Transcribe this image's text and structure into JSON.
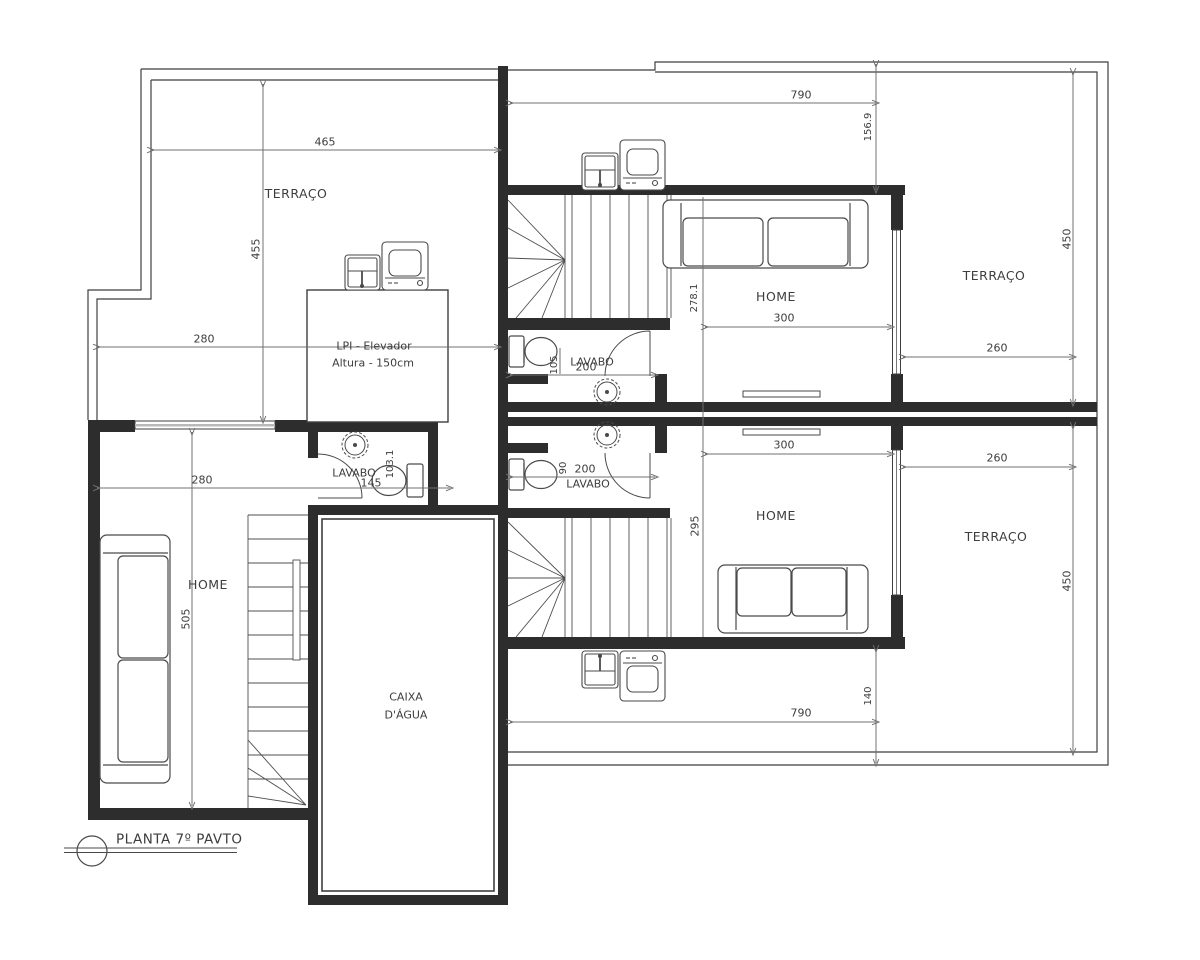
{
  "annotations": {
    "title": "PLANTA 7º PAVTO",
    "elevator_line1": "LPI - Elevador",
    "elevator_line2": "Altura - 150cm",
    "water_tank_line1": "CAIXA",
    "water_tank_line2": "D'ÁGUA"
  },
  "rooms": {
    "terrace_top_left": "TERRAÇO",
    "terrace_top_right": "TERRAÇO",
    "terrace_bottom_right": "TERRAÇO",
    "home_left": "HOME",
    "home_top_right": "HOME",
    "home_bottom_right": "HOME",
    "lavabo_left": "LAVABO",
    "lavabo_top": "LAVABO",
    "lavabo_bottom": "LAVABO"
  },
  "dims": {
    "w465": "465",
    "h455": "455",
    "w280_terrace": "280",
    "w280_home": "280",
    "h505": "505",
    "w145": "145",
    "h103": "103.1",
    "w790_top": "790",
    "h156": "156.9",
    "h450_top": "450",
    "w260_top": "260",
    "w300_top": "300",
    "h278": "278.1",
    "w200_top": "200",
    "h105": "105",
    "w300_bottom": "300",
    "h295": "295",
    "w200_bottom": "200",
    "h90": "90",
    "w260_bottom": "260",
    "h450_bottom": "450",
    "w790_bottom": "790",
    "h140": "140"
  },
  "icons": [
    "stairs",
    "sofa-icon",
    "toilet-icon",
    "laundry-sink-icon",
    "washing-machine-icon",
    "floor-drain-icon",
    "door-swing-icon",
    "window",
    "title-marker-circle"
  ],
  "colors": {
    "background": "#ffffff",
    "wall": "#2d2d2d",
    "outline": "#3f3f3f",
    "dimension_line": "#707070",
    "window_glass": "#b9b9b9",
    "text": "#3d3d3d"
  }
}
